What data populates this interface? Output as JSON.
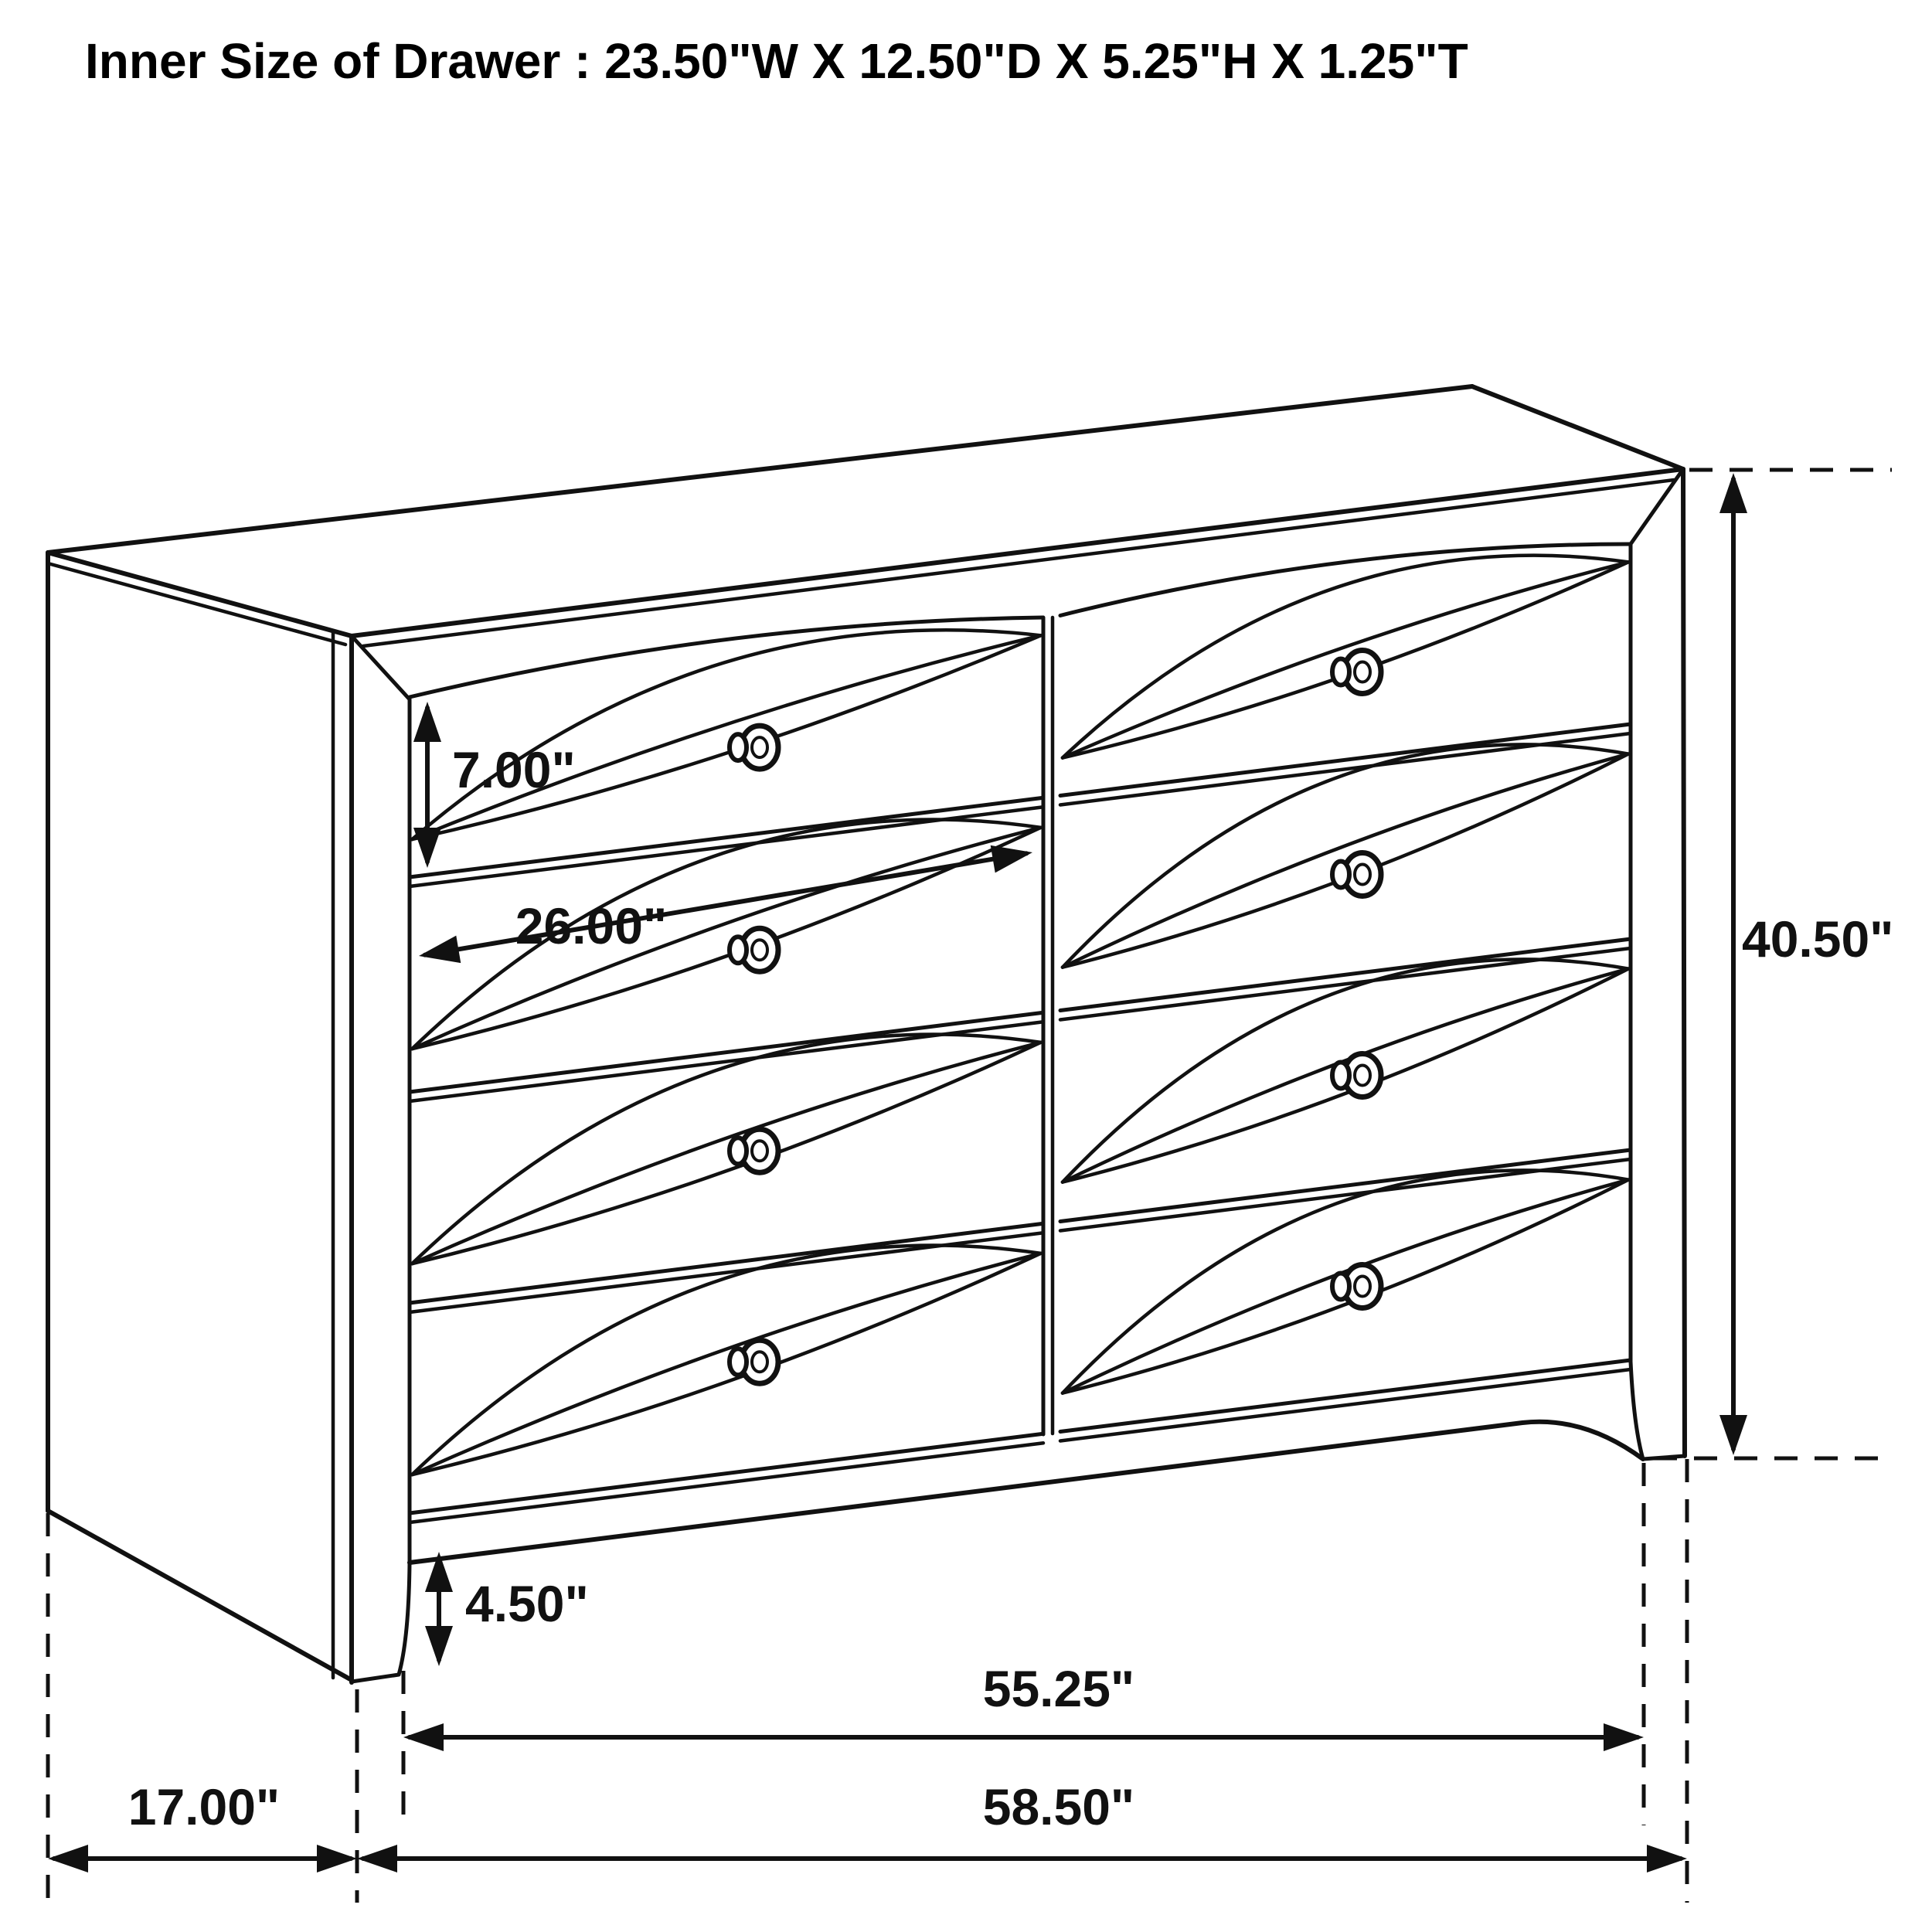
{
  "title": "Inner Size of Drawer : 23.50\"W X 12.50\"D X 5.25\"H X 1.25\"T",
  "dimensions": {
    "drawer_face_height": "7.00\"",
    "drawer_opening_width": "26.00\"",
    "overall_height": "40.50\"",
    "foot_height": "4.50\"",
    "front_width": "55.25\"",
    "side_depth": "17.00\"",
    "overall_width": "58.50\""
  },
  "drawing": {
    "subject": "dresser",
    "drawer_columns": 2,
    "drawer_rows": 4,
    "line_color": "#111111",
    "background_color": "#ffffff"
  }
}
